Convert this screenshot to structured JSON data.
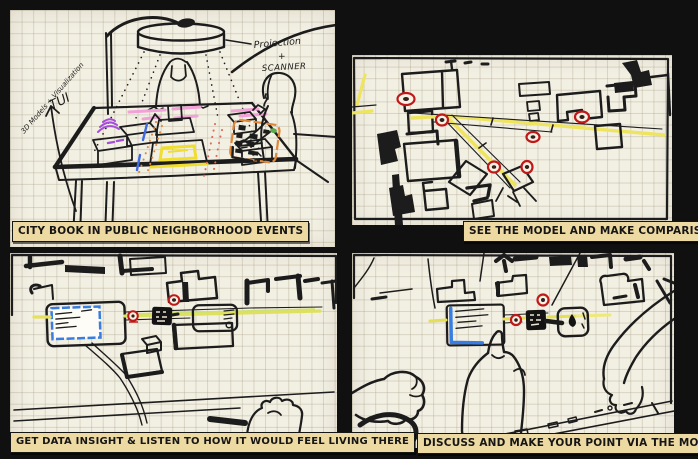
{
  "title": "City Book storyboard sketches",
  "colors": {
    "background": "#101010",
    "paper": "#f2efe3",
    "grid_line": "#c9c2ab",
    "caption_bg": "#edd9a2",
    "caption_text": "#161616",
    "ink": "#1c1c1c",
    "road_yellow": "#eee45e",
    "marker_red": "#c01818",
    "card_blue": "#3a7de0",
    "highlight_pink": "#f2a0d8",
    "highlight_purple": "#a44fd8",
    "highlight_orange": "#e0883a",
    "highlight_yellow": "#f0de2e",
    "highlight_green": "#5cab4c"
  },
  "panels": [
    {
      "id": "city-book",
      "caption": "CITY BOOK IN PUBLIC NEIGHBORHOOD EVENTS",
      "annotations": {
        "models": "3D Models + Visualization",
        "tui": "TUI",
        "projection": "Projection",
        "plus": "+",
        "scanner": "SCANNER"
      }
    },
    {
      "id": "see-model",
      "caption": "SEE THE MODEL AND MAKE COMPARISON",
      "marker_count": 6
    },
    {
      "id": "data-insight",
      "caption": "GET DATA INSIGHT & LISTEN TO HOW IT WOULD FEEL LIVING THERE",
      "marker_count": 2
    },
    {
      "id": "discuss",
      "caption": "DISCUSS AND MAKE YOUR POINT VIA THE MODEL",
      "marker_count": 2
    }
  ]
}
